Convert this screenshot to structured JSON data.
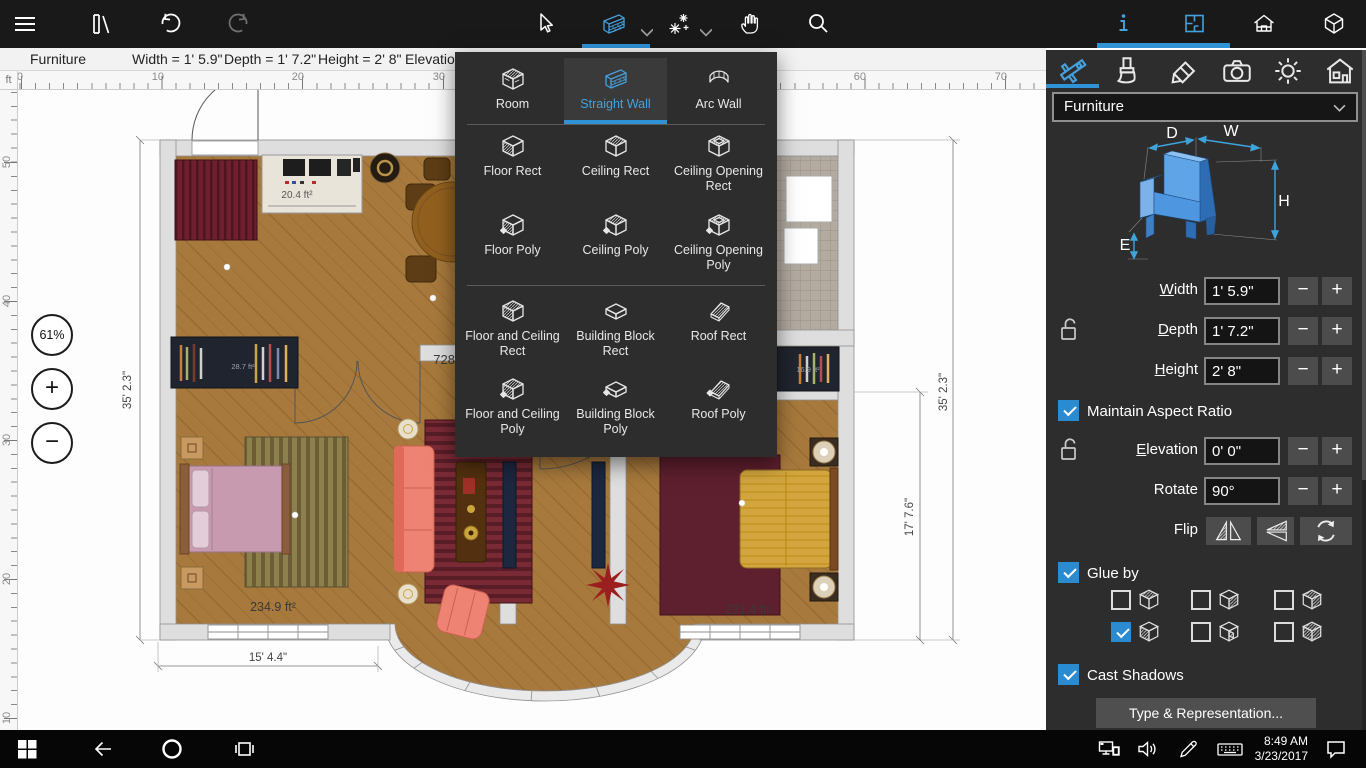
{
  "topbar": {
    "left_icons": [
      "menu",
      "library",
      "undo",
      "redo"
    ],
    "center_icons": [
      "select-cursor",
      "straight-wall-tool",
      "smart-tools",
      "pan-hand",
      "search"
    ],
    "right_icons": [
      "info",
      "plan-2d-view",
      "elevation-view",
      "view-3d"
    ],
    "accent_color": "#2f93d6"
  },
  "status": {
    "selection": "Furniture",
    "width": "Width = 1' 5.9\"",
    "depth": "Depth = 1' 7.2\"",
    "height": "Height = 2' 8\"",
    "elevation": "Elevation"
  },
  "ruler": {
    "unit": "ft",
    "h_labels": [
      "0",
      "10",
      "20",
      "30",
      "40",
      "50",
      "60",
      "70"
    ],
    "v_labels": [
      "50",
      "40",
      "30",
      "20",
      "10"
    ]
  },
  "zoom_hud": {
    "level": "61%",
    "plus": "+",
    "minus": "−"
  },
  "plan": {
    "living_area": "728",
    "tv_area": "20.4 ft²",
    "shelf_left_area": "28.7 ft²",
    "shelf_right_area": "16.9 ft²",
    "bedroom_left_area": "234.9 ft²",
    "bedroom_right_area": "231.4 ft²",
    "dim_left": "35' 2.3\"",
    "dim_bottom": "15' 4.4\"",
    "dim_right_inner": "17' 7.6\"",
    "dim_right_outer": "35' 2.3\""
  },
  "tool_dropdown": {
    "items": [
      {
        "label": "Room",
        "selected": false
      },
      {
        "label": "Straight Wall",
        "selected": true
      },
      {
        "label": "Arc Wall",
        "selected": false
      },
      {
        "label": "Floor Rect",
        "selected": false
      },
      {
        "label": "Ceiling Rect",
        "selected": false
      },
      {
        "label": "Ceiling Opening Rect",
        "selected": false
      },
      {
        "label": "Floor Poly",
        "selected": false
      },
      {
        "label": "Ceiling Poly",
        "selected": false
      },
      {
        "label": "Ceiling Opening Poly",
        "selected": false
      },
      {
        "label": "Floor and Ceiling Rect",
        "selected": false
      },
      {
        "label": "Building Block Rect",
        "selected": false
      },
      {
        "label": "Roof Rect",
        "selected": false
      },
      {
        "label": "Floor and Ceiling Poly",
        "selected": false
      },
      {
        "label": "Building Block Poly",
        "selected": false
      },
      {
        "label": "Roof Poly",
        "selected": false
      }
    ]
  },
  "inspector": {
    "tabs": [
      "object-size",
      "materials",
      "edit",
      "camera",
      "light",
      "building"
    ],
    "category": "Furniture",
    "diagram": {
      "d": "D",
      "w": "W",
      "h": "H",
      "e": "E"
    },
    "size_fields": [
      {
        "label": "Width",
        "value": "1' 5.9\""
      },
      {
        "label": "Depth",
        "value": "1' 7.2\""
      },
      {
        "label": "Height",
        "value": "2' 8\""
      }
    ],
    "stepper": {
      "minus": "−",
      "plus": "+"
    },
    "maintain_aspect_ratio": {
      "label": "Maintain Aspect Ratio",
      "checked": true
    },
    "elevation": {
      "label": "Elevation",
      "value": "0' 0\""
    },
    "rotate": {
      "label": "Rotate",
      "value": "90°"
    },
    "flip": {
      "label": "Flip"
    },
    "glue_by": {
      "label": "Glue by",
      "checked": true,
      "cells": [
        {
          "checked": false
        },
        {
          "checked": false
        },
        {
          "checked": false
        },
        {
          "checked": true
        },
        {
          "checked": false
        },
        {
          "checked": false
        }
      ]
    },
    "cast_shadows": {
      "label": "Cast Shadows",
      "checked": true
    },
    "type_representation": "Type & Representation..."
  },
  "taskbar": {
    "time": "8:49 AM",
    "date": "3/23/2017"
  }
}
